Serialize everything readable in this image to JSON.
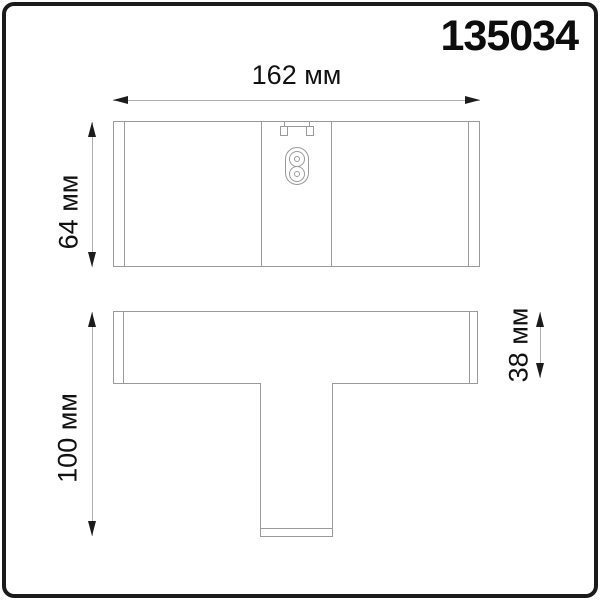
{
  "product": {
    "id": "135034"
  },
  "drawing": {
    "top_view": {
      "width_dim_label": "162 мм",
      "height_dim_label": "64 мм"
    },
    "profile_view": {
      "height_dim_label": "100 мм",
      "flange_dim_label": "38 мм"
    }
  },
  "icons": {
    "power_connector": "two-pole-socket-icon",
    "mounting_clip": "clip-icon"
  },
  "colors": {
    "frame_border": "#1a1a1a",
    "shape_line": "#9a9a9a",
    "dim_line": "#b0b0b0",
    "arrow": "#1c1c1c",
    "text": "#111111",
    "bg": "#ffffff"
  }
}
